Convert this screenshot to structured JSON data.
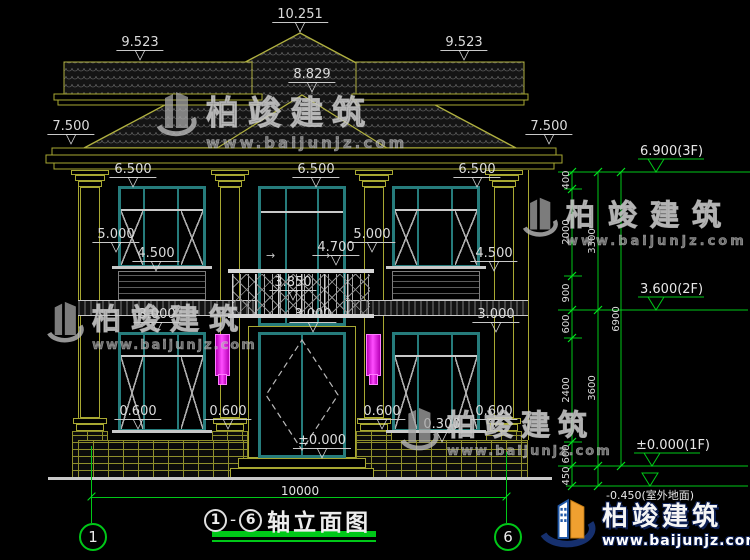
{
  "markers": [
    "10.251",
    "9.523",
    "9.523",
    "8.829",
    "7.500",
    "7.500",
    "6.500",
    "6.500",
    "6.500",
    "5.000",
    "5.000",
    "4.500",
    "4.500",
    "4.700",
    "3.850",
    "3.000",
    "3.000",
    "3.000",
    "0.600",
    "0.600",
    "0.600",
    "0.600",
    "0.300",
    "±0.000"
  ],
  "floor_levels": [
    "6.900(3F)",
    "3.600(2F)",
    "±0.000(1F)",
    "-0.450(室外地面)"
  ],
  "dim_chain": {
    "col1": [
      "400",
      "2000",
      "900",
      "600",
      "2400",
      "600",
      "450"
    ],
    "col2": [
      "3300",
      "3600"
    ],
    "col3": [
      "6900"
    ]
  },
  "overall_dim": "10000",
  "axis_bubbles": [
    "1",
    "6"
  ],
  "title": {
    "from": "1",
    "dash": "-",
    "to": "6",
    "label": "轴立面图"
  },
  "watermark": {
    "brand": "柏竣建筑",
    "url": "www.baijunjz.com"
  },
  "icons": {
    "triangle_down": "▽",
    "arrow_right": "→"
  },
  "colors": {
    "background": "#000000",
    "line_olive": "#a8a832",
    "window_teal": "#267c7c",
    "dimension_green": "#00c818",
    "text_white": "#dcdcdc",
    "lamp_magenta": "#f020f0",
    "logo_blue": "#2058a8",
    "logo_orange": "#f0a030",
    "logo_navy": "#16306e",
    "watermark_gray": "#a5a5a5"
  }
}
